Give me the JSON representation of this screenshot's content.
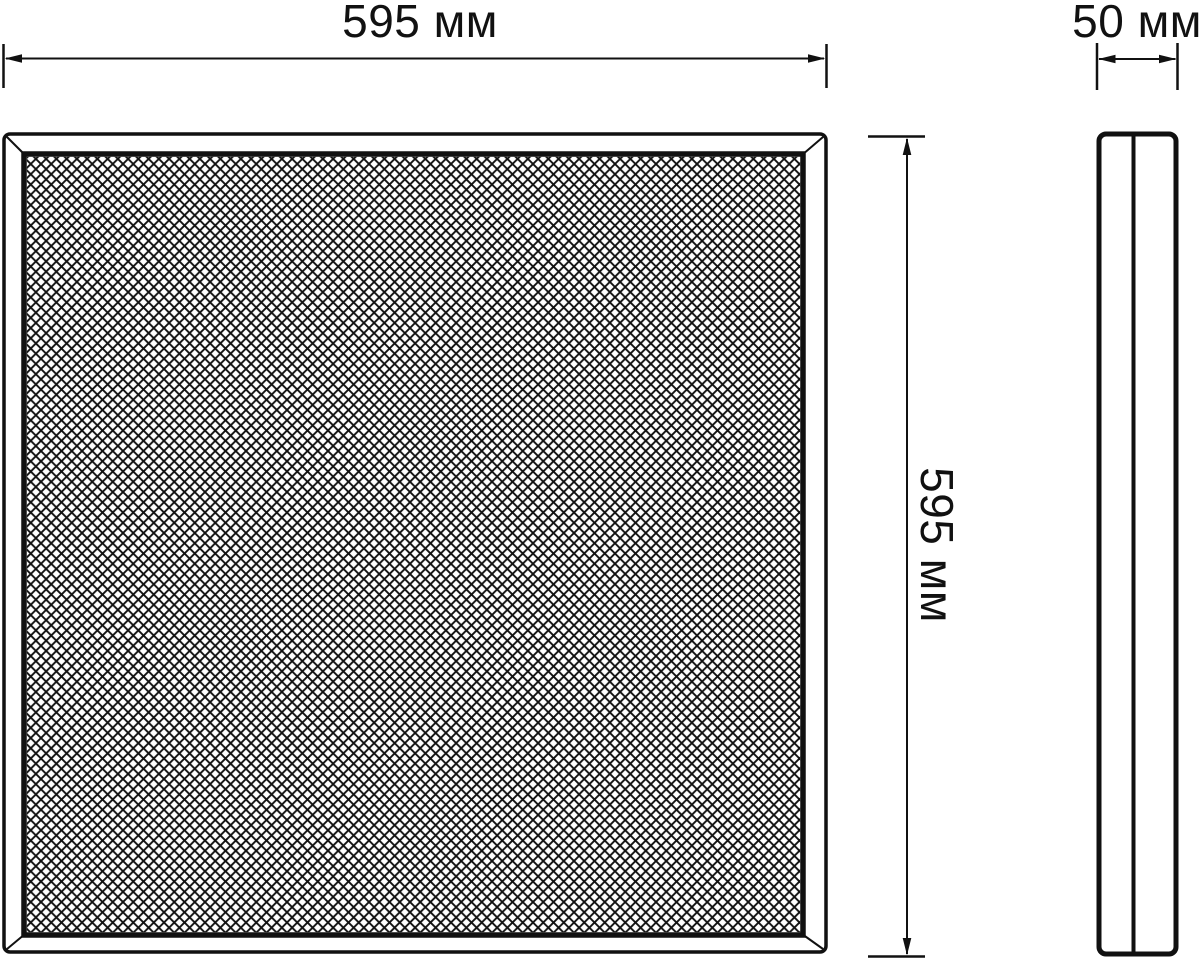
{
  "title": "Panel light technical dimension drawing",
  "colors": {
    "ink": "#111111",
    "background": "#ffffff"
  },
  "views": {
    "front": {
      "name": "front view — square panel with diamond mesh diffuser",
      "mesh_pattern": "diamond crosshatch 45deg"
    },
    "side": {
      "name": "side profile — thin panel edge with divider line"
    }
  },
  "dimensions": {
    "width": {
      "label": "595 мм",
      "value": 595,
      "unit": "мм"
    },
    "height": {
      "label": "595 мм",
      "value": 595,
      "unit": "мм"
    },
    "depth": {
      "label": "50 мм",
      "value": 50,
      "unit": "мм"
    }
  }
}
